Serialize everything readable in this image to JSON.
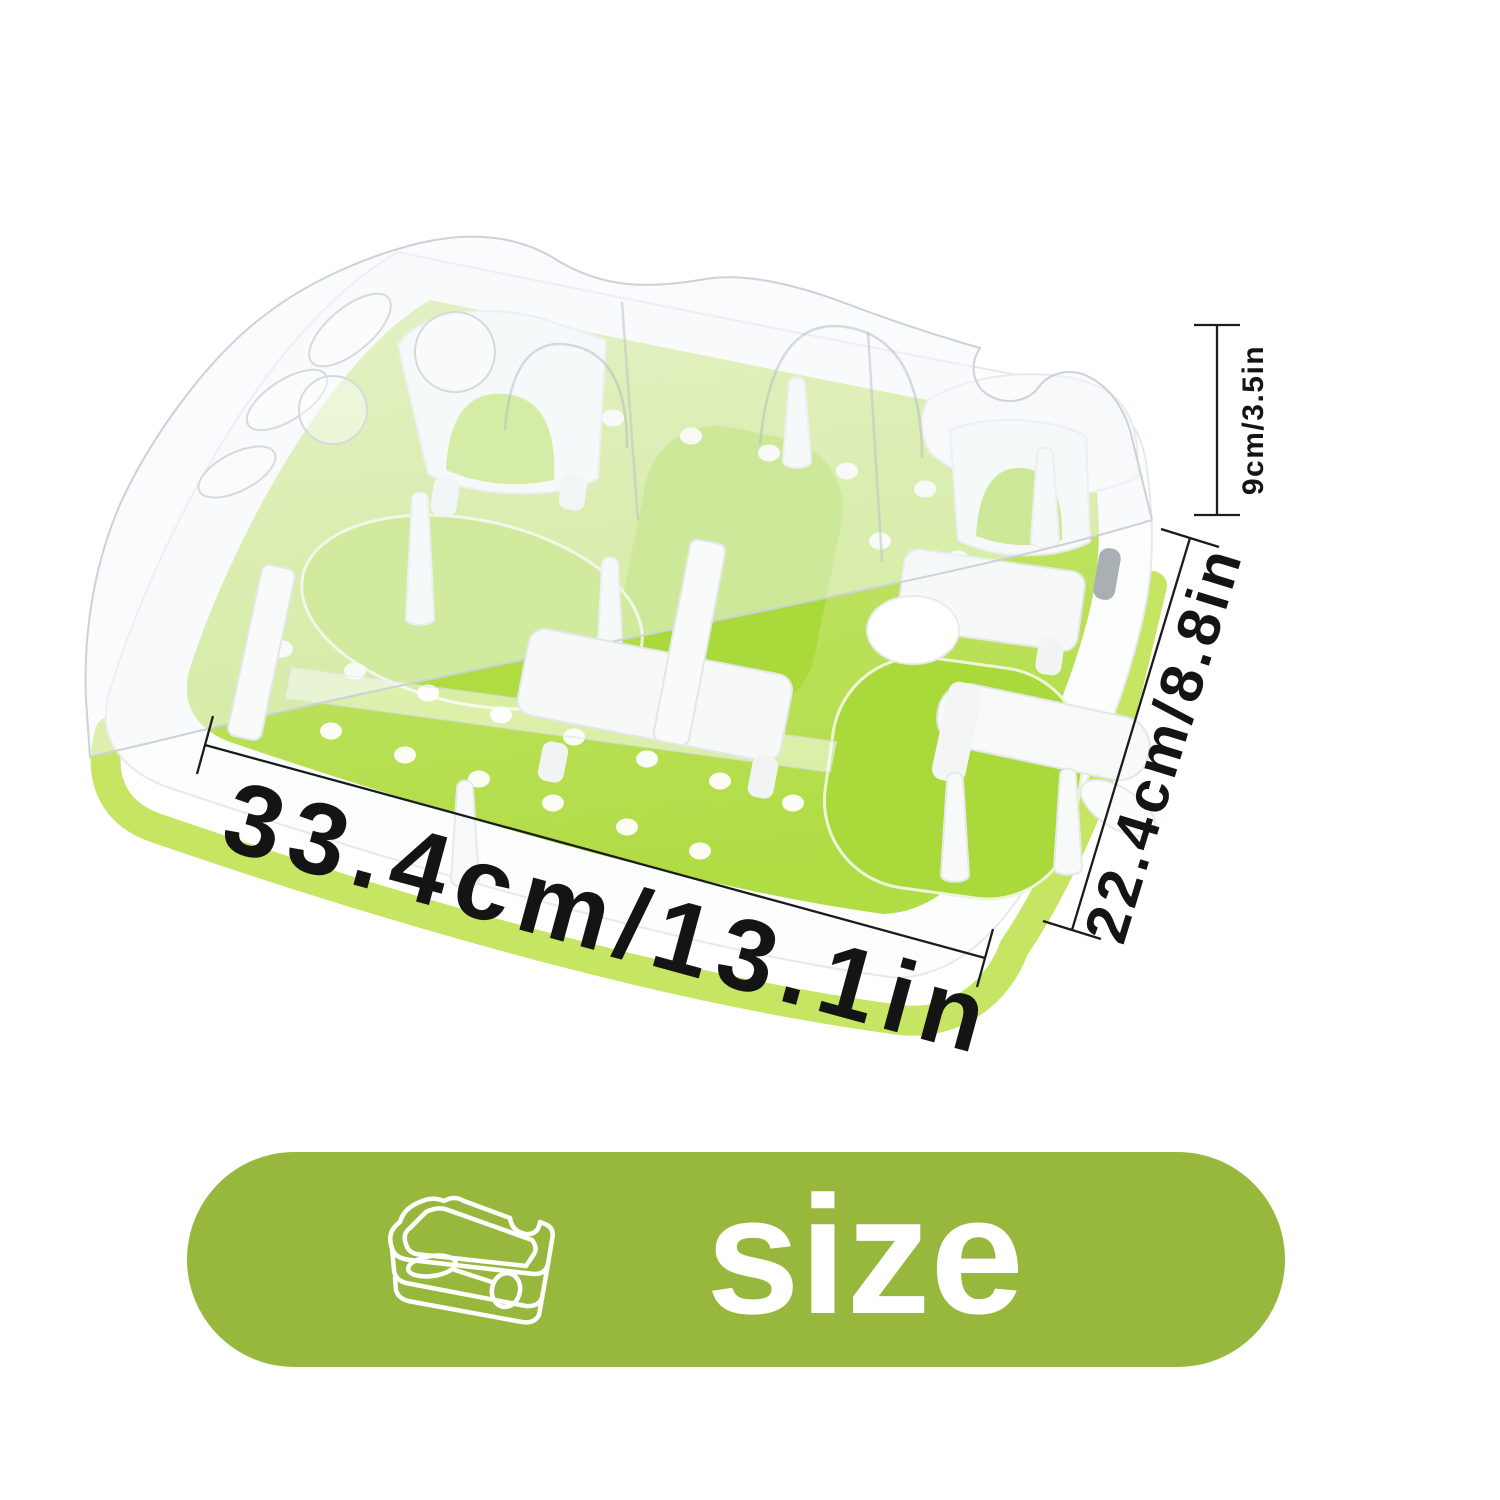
{
  "page": {
    "width": 1500,
    "height": 1500,
    "background": "#ffffff"
  },
  "product": {
    "kind": "pet-puzzle-feeder-tray-illustration",
    "colors": {
      "board_green": "#b6de4e",
      "board_green_dark": "#a9d93a",
      "base_green": "#c6e562",
      "plastic_white": "#fbfcfd",
      "cover_tint": "#f3f7f8",
      "outline": "#e3e7e9"
    }
  },
  "dimensions": {
    "width": {
      "label": "33.4cm/13.1in"
    },
    "depth": {
      "label": "22.4cm/8.8in"
    },
    "height": {
      "label": "9cm/3.5in"
    },
    "line_color": "#1c1c1c",
    "text_color": "#141414"
  },
  "size_badge": {
    "label": "size",
    "icon": "tray-outline-icon",
    "background": "#97b83d",
    "text_color": "#ffffff"
  }
}
